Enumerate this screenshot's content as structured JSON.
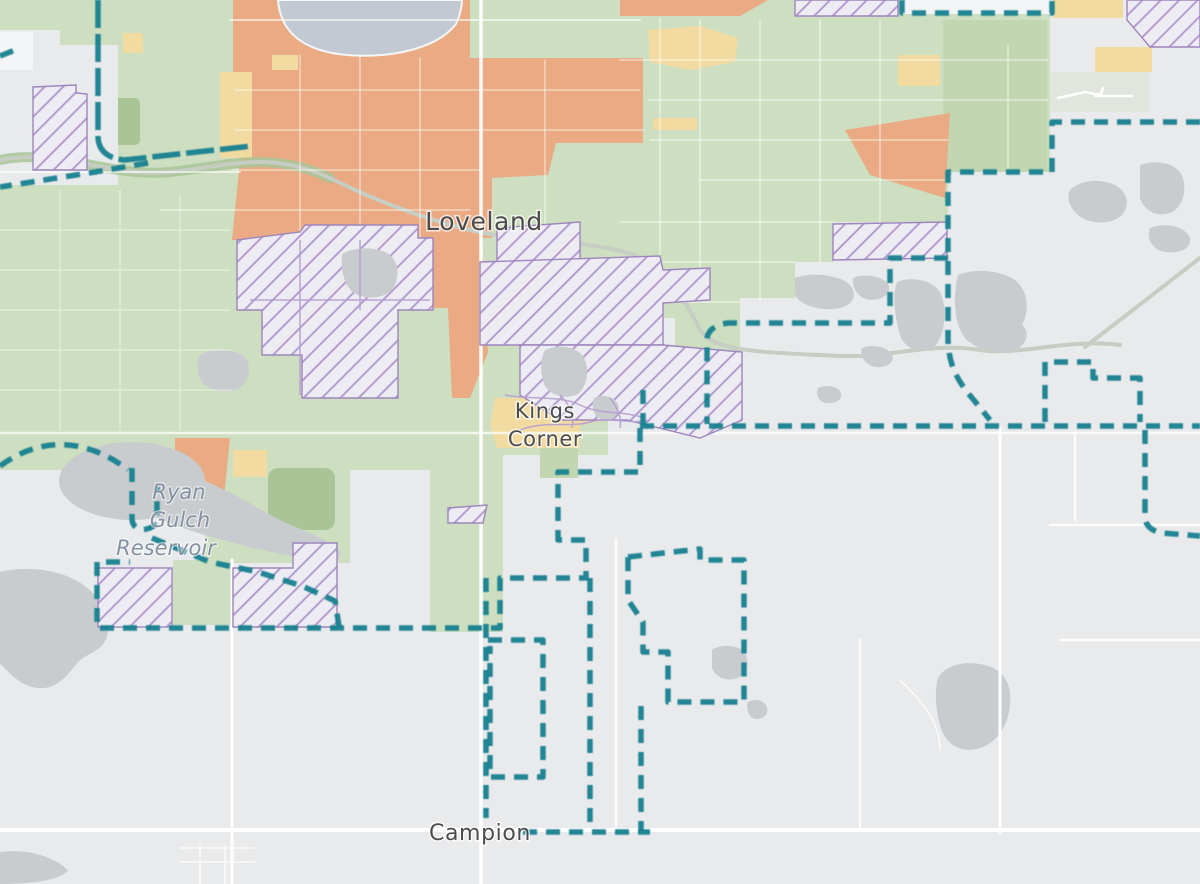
{
  "map": {
    "labels": {
      "city": {
        "text": "Loveland"
      },
      "locality": {
        "line1": "Kings",
        "line2": "Corner"
      },
      "waterbody": {
        "line1": "Ryan",
        "line2": "Gulch",
        "line3": "Reservoir"
      },
      "town": {
        "text": "Campion"
      }
    },
    "colors": {
      "background": "#e9eaec",
      "city_fill": "#cddfc0",
      "city_fill_dark": "#c2d7b1",
      "park_fill": "#a9c598",
      "urban_fill": "#e9aa84",
      "commercial_fill": "#f2dba0",
      "water_fill": "#c3c9d3",
      "pond_fill": "#c9cccf",
      "hatch_fill": "#edecf2",
      "hatch_line": "#b49dd1",
      "hatch_edge": "#9e85bd",
      "boundary": "#14808f",
      "road": "#ffffff",
      "river": "#c6cdc2",
      "label": "#4c4c4e",
      "water_label": "#8591a2"
    }
  }
}
